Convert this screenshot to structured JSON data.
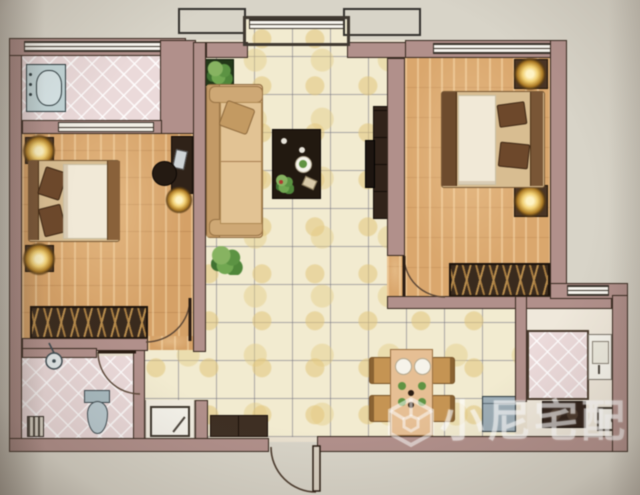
{
  "watermark": {
    "brand_text": "小尼宅配",
    "logo_icon": "cube-logo-icon"
  },
  "palette": {
    "photo_background": "#d8d4c8",
    "wall": "#b2908a",
    "wall_outline": "#38291f",
    "wood_floor_left_bedroom": "#d7a164",
    "wood_floor_right_bedroom": "#dca76a",
    "ceramic_tile_living": "#f2ebcf",
    "tile_grout_line": "#6e6e7d",
    "pink_diamond_tile": "#ecdada",
    "dark_furniture": "#33241a",
    "upholstery_tan": "#d9b383",
    "bedding_white": "#f1e9d6",
    "fixture_blue_grey": "#c2d6d8",
    "lamp_glow": "#f2cf6e",
    "plant_green": "#5a9440",
    "watermark_white": "rgba(255,255,255,0.52)"
  }
}
